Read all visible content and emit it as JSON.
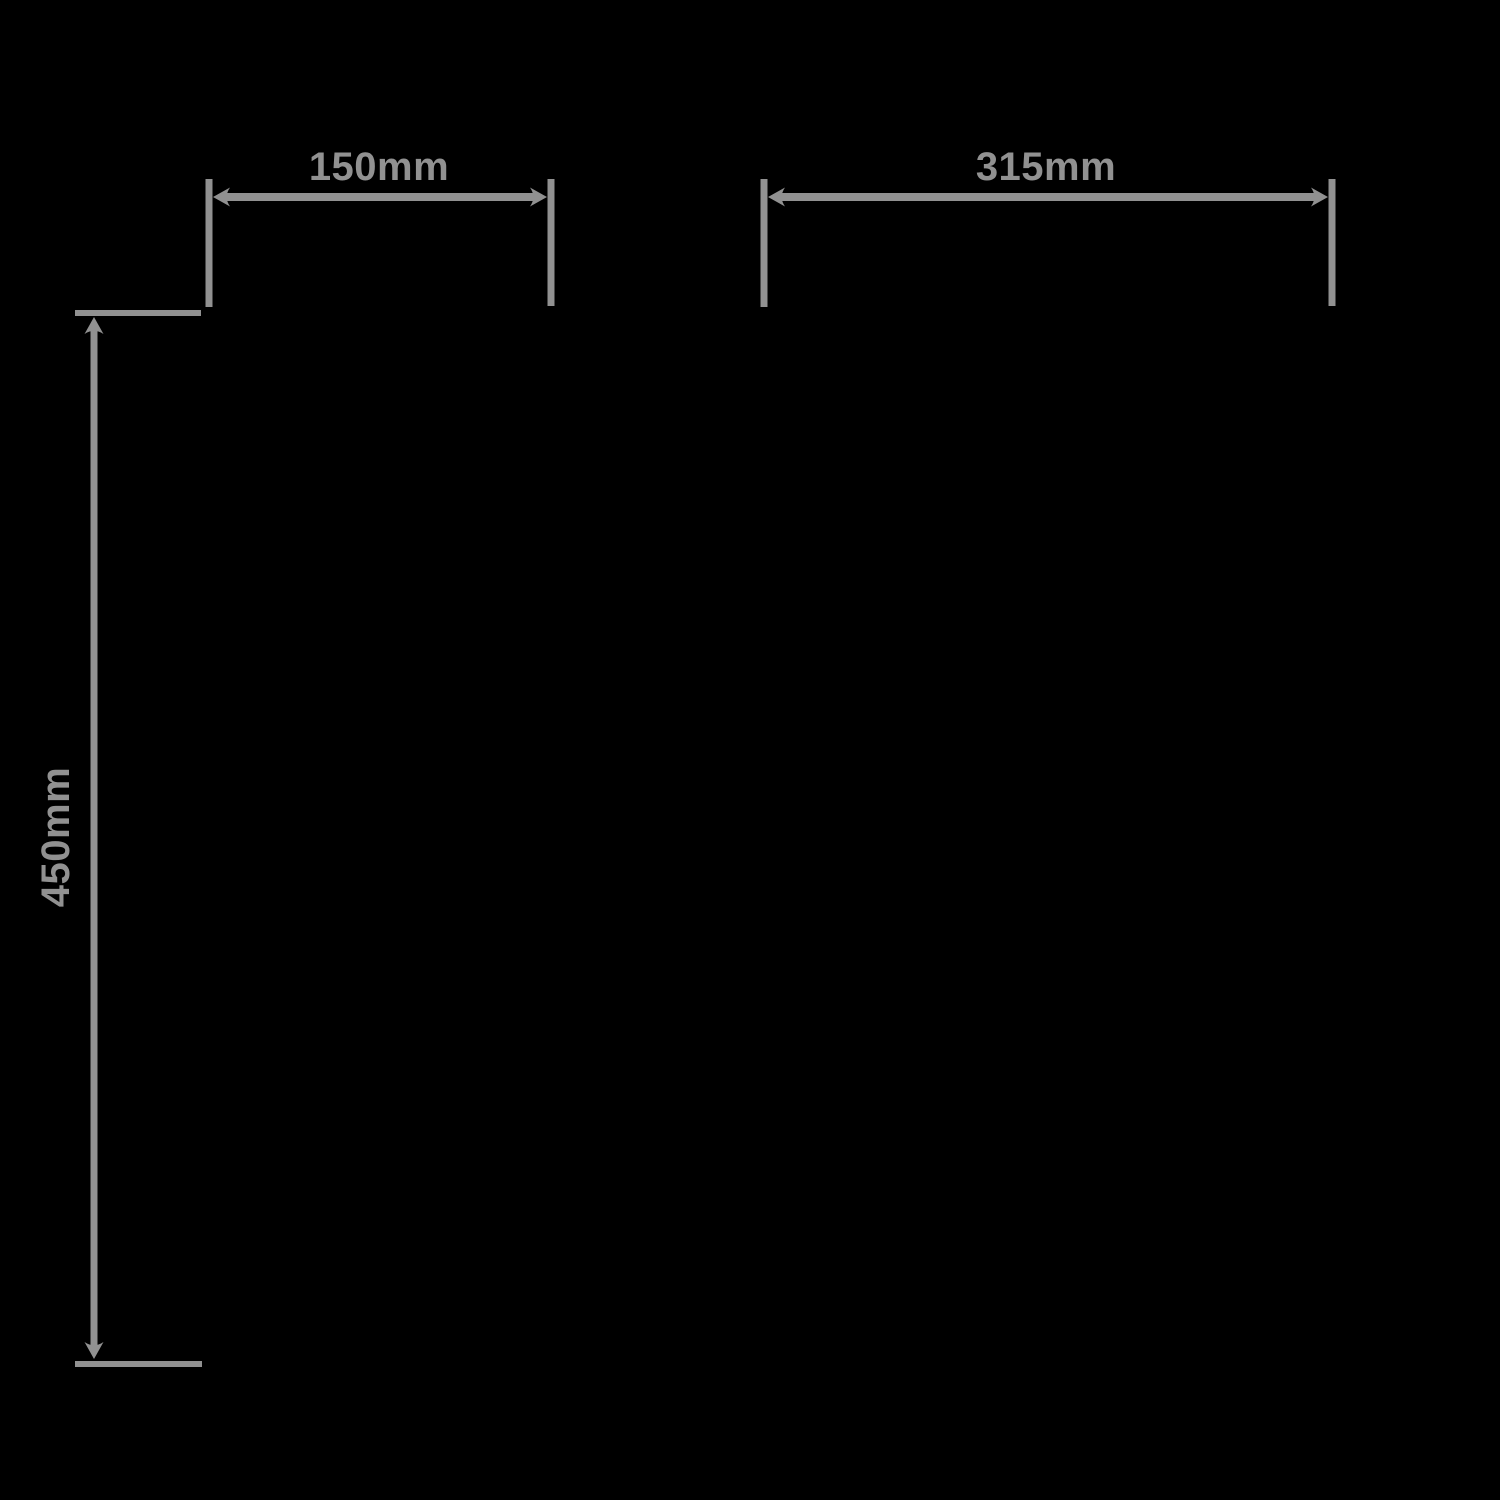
{
  "diagram": {
    "kind": "dimension-drawing",
    "background_color": "#000000",
    "line_color": "#919191",
    "dimensions": [
      {
        "id": "top-left-width",
        "label": "150mm",
        "orientation": "horizontal",
        "position": "top-left"
      },
      {
        "id": "top-right-width",
        "label": "315mm",
        "orientation": "horizontal",
        "position": "top-right"
      },
      {
        "id": "left-height",
        "label": "450mm",
        "orientation": "vertical",
        "position": "left"
      }
    ]
  }
}
